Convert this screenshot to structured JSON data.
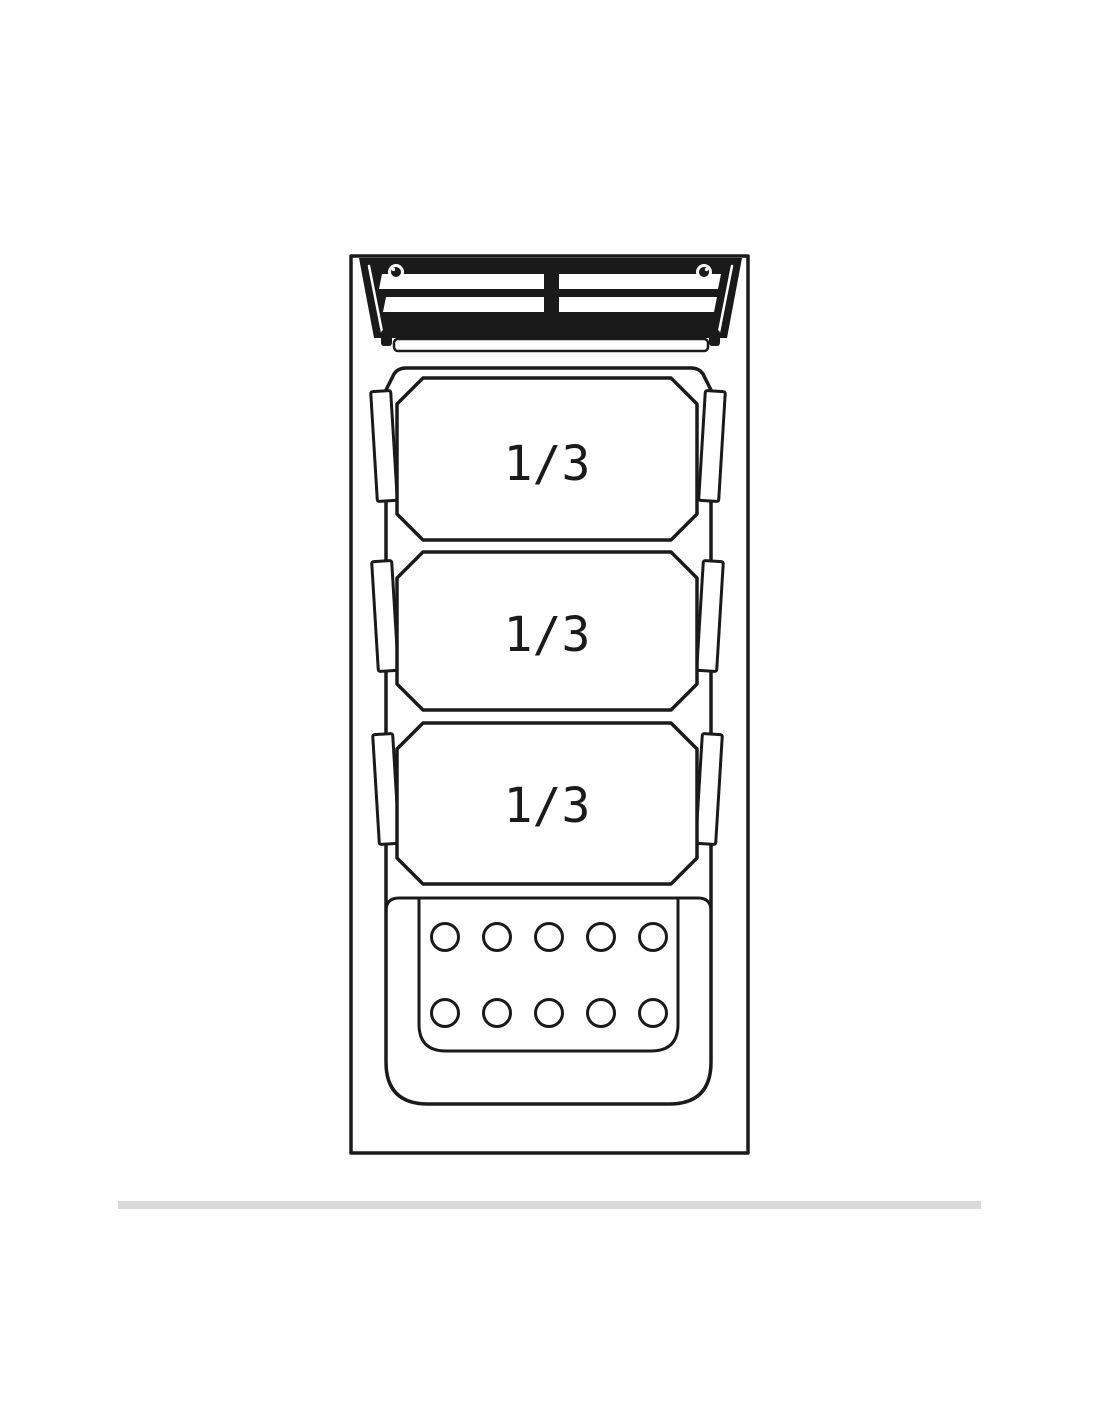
{
  "diagram": {
    "colors": {
      "line": "#1a1a1a",
      "background": "#ffffff",
      "divider_rule": "#d9d9d9"
    },
    "pans": [
      {
        "label": "1/3"
      },
      {
        "label": "1/3"
      },
      {
        "label": "1/3"
      }
    ],
    "perforated_plate": {
      "hole_rows": 2,
      "hole_columns": 5
    }
  }
}
